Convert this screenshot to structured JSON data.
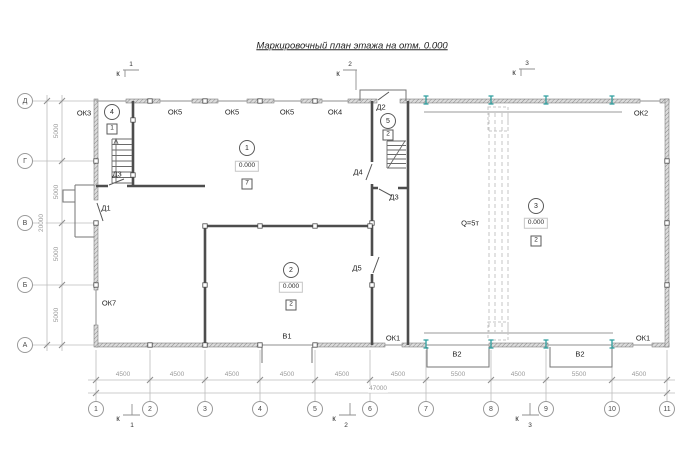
{
  "title": "Маркировочный план этажа на отм. 0.000",
  "grid": {
    "columns": [
      "1",
      "2",
      "3",
      "4",
      "5",
      "6",
      "7",
      "8",
      "9",
      "10",
      "11"
    ],
    "rows": [
      "Д",
      "Г",
      "В",
      "Б",
      "А"
    ],
    "column_spacings": [
      "4500",
      "4500",
      "4500",
      "4500",
      "4500",
      "4500",
      "5500",
      "4500",
      "5500",
      "4500"
    ],
    "total_length": "47000",
    "row_spacings": [
      "5000",
      "5000",
      "5000",
      "5000"
    ],
    "total_depth": "20000"
  },
  "section_marks": [
    {
      "letter": "к",
      "number": "1"
    },
    {
      "letter": "к",
      "number": "2"
    },
    {
      "letter": "к",
      "number": "3"
    }
  ],
  "rooms": [
    {
      "number": "1",
      "elevation": "0.000",
      "finish": "7"
    },
    {
      "number": "2",
      "elevation": "0.000",
      "finish": "2"
    },
    {
      "number": "3",
      "elevation": "0.000",
      "finish": "2"
    },
    {
      "number": "4",
      "finish": "1"
    },
    {
      "number": "5",
      "finish": "2"
    }
  ],
  "openings": {
    "windows": [
      "ОК3",
      "ОК5",
      "ОК5",
      "ОК5",
      "ОК4",
      "ОК2",
      "ОК7",
      "ОК1",
      "ОК1"
    ],
    "doors": [
      "Д1",
      "Д2",
      "Д3",
      "Д3",
      "Д4",
      "Д5"
    ],
    "gates": [
      "В1",
      "В2",
      "В2"
    ]
  },
  "crane": {
    "capacity": "Q=5т"
  },
  "colors": {
    "wall": "#6e6e6e",
    "interior_wall": "#4d4d4d",
    "dim": "#b5b5b5",
    "text": "#1f1f1f",
    "accent": "#2e9e9e"
  }
}
